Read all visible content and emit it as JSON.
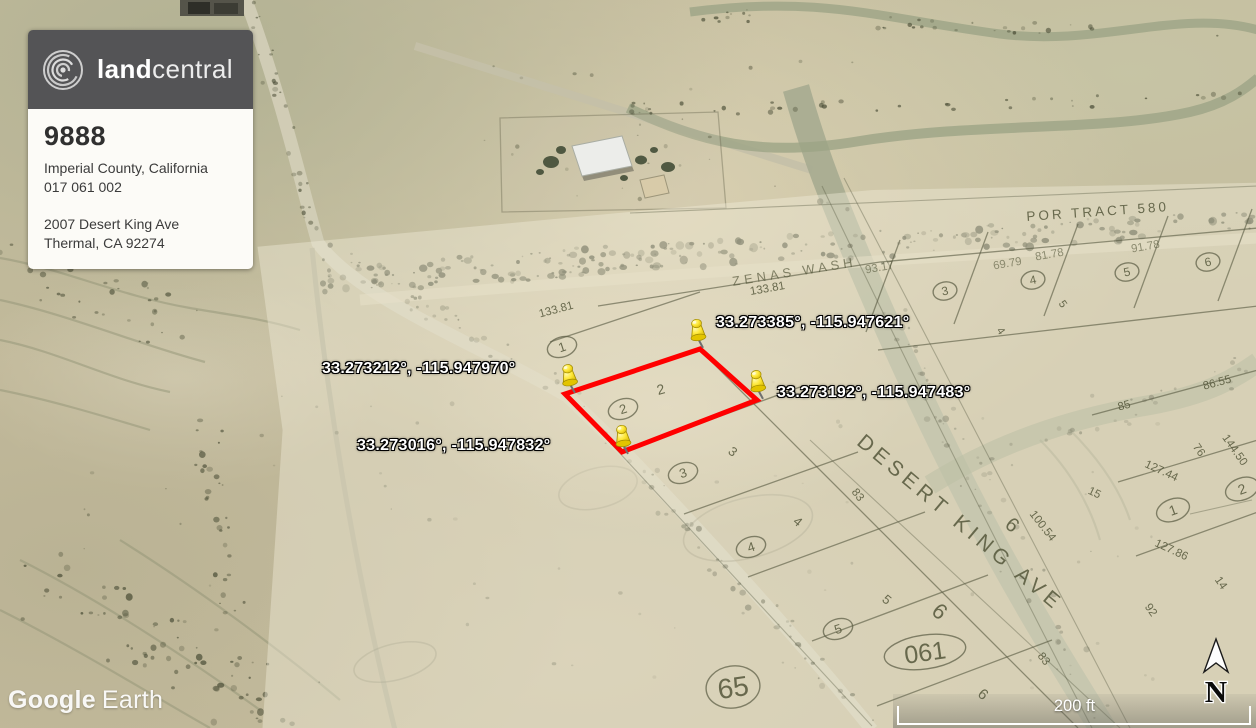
{
  "header_card": {
    "logo_text_bold": "land",
    "logo_text_light": "central",
    "listing_id": "9888",
    "location_line": "Imperial County, California",
    "apn_line": "017 061 002",
    "address_line1": "2007 Desert King Ave",
    "address_line2": "Thermal, CA 92274"
  },
  "watermark": {
    "word1": "Google",
    "word2": "Earth"
  },
  "scale_bar": {
    "label": "200 ft"
  },
  "compass": {
    "label": "N"
  },
  "pins": [
    {
      "name": "north",
      "coords": "33.273385°, -115.947621°"
    },
    {
      "name": "west",
      "coords": "33.273212°, -115.947970°"
    },
    {
      "name": "south",
      "coords": "33.273016°, -115.947832°"
    },
    {
      "name": "east",
      "coords": "33.273192°, -115.947483°"
    }
  ],
  "parcel": {
    "outline_color": "#ff0000"
  },
  "plat": {
    "tract_label": "POR TRACT 580",
    "wash_label": "ZENAS WASH",
    "street_label": "DESERT KING AVE",
    "block_ovals": [
      "65",
      "061"
    ],
    "lots_west": [
      "1",
      "2",
      "3",
      "4",
      "5"
    ],
    "lots_east": [
      "3",
      "4",
      "5",
      "6"
    ],
    "lots_right": [
      "1",
      "2"
    ],
    "lots_plain": [
      "2",
      "3",
      "4",
      "5",
      "6",
      "6",
      "6",
      "3",
      "4",
      "5"
    ],
    "dims": [
      "133.81",
      "133.81",
      "93.17",
      "69.79",
      "81.78",
      "91.78",
      "86.55",
      "85",
      "76",
      "144.50",
      "127.44",
      "15",
      "127.86",
      "14",
      "92",
      "100.54",
      "83",
      "83"
    ]
  },
  "colors": {
    "parcel_red": "#ff0000",
    "pin_yellow": "#ffe93c",
    "card_header_gray": "#545456",
    "plat_ink": "#585a42"
  }
}
